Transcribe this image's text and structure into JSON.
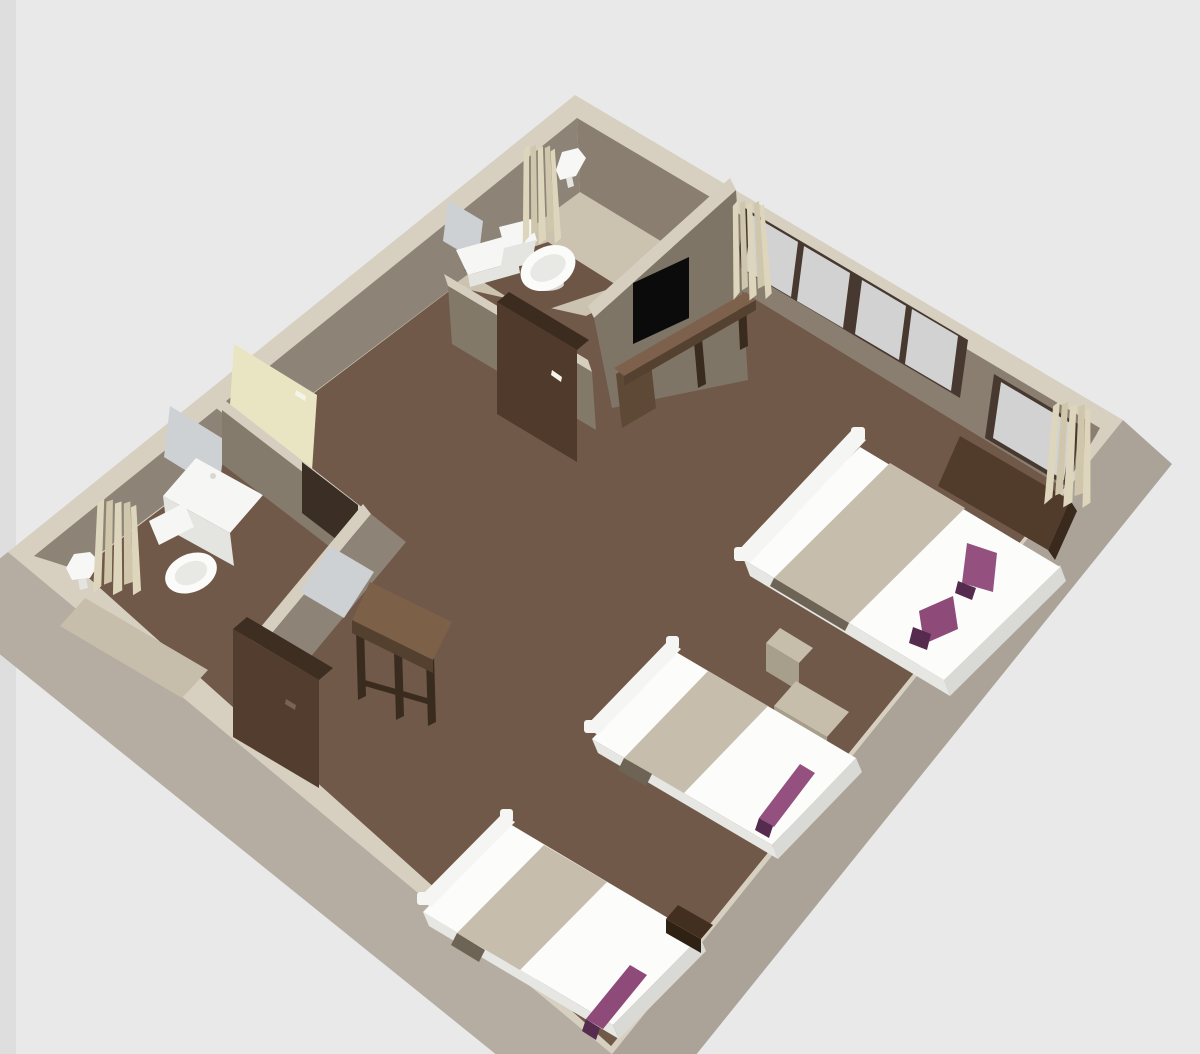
{
  "scene": {
    "title": "3D floor plan render",
    "description": "Overhead 3D render of a guest room: three beds with purple runners, TV partition wall, two bathroom areas, wardrobe, dresser, desk, window band with curtains",
    "view": "3d-overhead",
    "background": "#e9e9e9"
  },
  "colors": {
    "bg": "#e9e9e9",
    "bg_edge": "#dedede",
    "wall_cap": "#d7d0c0",
    "partition_cap": "#d6cfbf",
    "wall_outer_sw": "#b5ada2",
    "wall_outer_se": "#aba398",
    "wall_inner_nw": "#8d8376",
    "wall_inner_ne": "#897e70",
    "wall_inner_se": "#8d8275",
    "wall_inner_sw": "#9a9184",
    "partition_face": "#857b6d",
    "tv_wall_face": "#7f7567",
    "sw_partition_face": "#837969",
    "p2_face": "#8d8376",
    "doorway_shadow": "#3b2f25",
    "floor": "#705949",
    "bath_floor": "#cbc2af",
    "bath_floor_strip": "#c6bdab",
    "wet_zone": "#6d5646",
    "window_frame": "#473930",
    "window_pane": "#d2d2d2",
    "mirror": "#cdd1d3",
    "door": "#e9e5c3",
    "handle_light": "#f5f3ea",
    "fixture_white": "#f6f6f4",
    "fixture_front": "#e4e4e0",
    "basin": "#fbfbf9",
    "basin_inner": "#e8e8e4",
    "basin_base": "#d8d8d3",
    "mattress": "#fcfcfb",
    "bed_skirt_foot": "#d9d9d5",
    "bed_skirt_side": "#e6e6e2",
    "headboard": "#f5f5f3",
    "blanket": "#c6bdac",
    "blanket_shadow": "#6e6455",
    "runner": "#94517f",
    "runner_alt": "#8e4a78",
    "runner_dark": "#552c4d",
    "nightstand_top": "#c6bdab",
    "nightstand_front": "#a89e8c",
    "dark_panel": "#513b2b",
    "dark_panel_edge": "#3a291d",
    "wardrobe_top": "#3c2c1f",
    "wardrobe_front": "#4f3a2b",
    "console_top": "#7d614c",
    "console_under": "#55412f",
    "console_box": "#5e4936",
    "desk_top": "#7d6048",
    "desk_apron": "#54402e",
    "leg_dark": "#3a2b1f",
    "dresser_top": "#3e2e21",
    "dresser_front": "#523d2e",
    "dresser_handle": "#7a6350",
    "bench_top": "#432f20",
    "bench_front": "#302115",
    "curtain": "#ddd5bc",
    "curtain_dark": "#cfc6ab",
    "lamp": "#f7f7f5",
    "tv": "#0b0b0b"
  },
  "objects": [
    {
      "name": "room",
      "label": "guest room with perimeter walls"
    },
    {
      "name": "bathroom-top",
      "label": "upper bathroom: round basin, toilet, shelf, mirror, curtain, wall lamp"
    },
    {
      "name": "bathroom-left",
      "label": "left bathroom: vanity sink, toilet, mirror, curtain, wall lamp"
    },
    {
      "name": "entry-door",
      "label": "pale yellow entry door on north-west wall"
    },
    {
      "name": "tv",
      "label": "flat TV on partition wall"
    },
    {
      "name": "tv-console",
      "label": "long wooden console bench under TV"
    },
    {
      "name": "wardrobe",
      "label": "dark wardrobe cabinet"
    },
    {
      "name": "dresser",
      "label": "dark dresser cabinet"
    },
    {
      "name": "desk",
      "label": "wooden desk with legs"
    },
    {
      "name": "hall-mirror",
      "label": "mirror on partition facing desk"
    },
    {
      "name": "window-band",
      "label": "four-pane window band on north-east wall"
    },
    {
      "name": "window-single",
      "label": "single window near east corner"
    },
    {
      "name": "curtains",
      "label": "four beige curtain groups"
    },
    {
      "name": "bed-1",
      "label": "double bed, white bedding, beige fold, two purple runners"
    },
    {
      "name": "bed-2",
      "label": "single bed, white bedding, beige fold, purple runner"
    },
    {
      "name": "bed-3",
      "label": "single bed, white bedding, beige fold, purple runner"
    },
    {
      "name": "nightstand-1",
      "label": "tan nightstand between bed 1 and bed 2"
    },
    {
      "name": "nightstand-2",
      "label": "tan side table near wall"
    },
    {
      "name": "bench",
      "label": "small dark bench beside bed 3"
    },
    {
      "name": "headboard-panel",
      "label": "dark wood panel on east wall"
    }
  ]
}
